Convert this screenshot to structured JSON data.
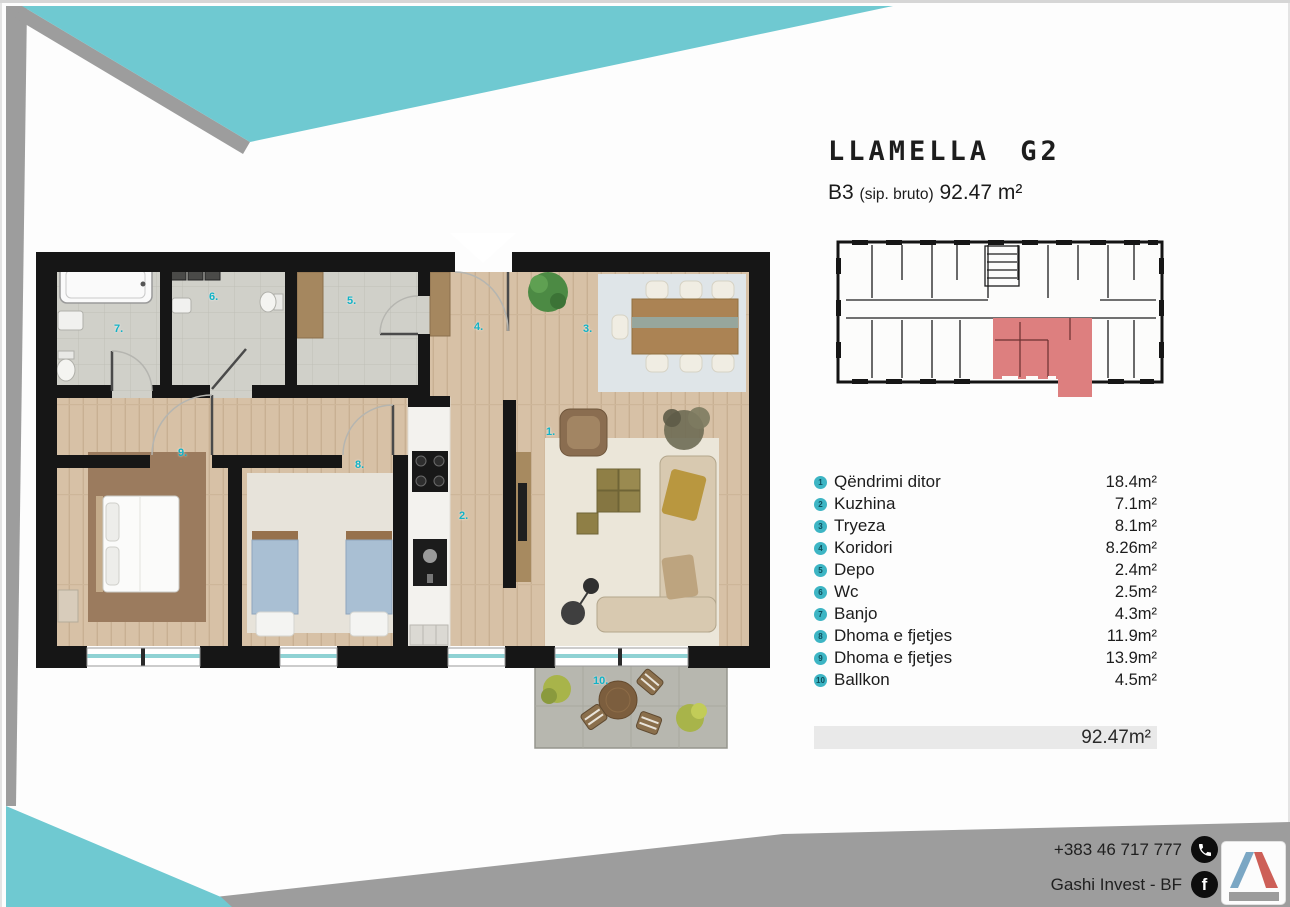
{
  "header": {
    "title": "LLAMELLA G2",
    "unit_code": "B3",
    "unit_note": "(sip. bruto)",
    "area": "92.47 m²"
  },
  "room_list": {
    "items": [
      {
        "n": "1",
        "name": "Qëndrimi ditor",
        "area": "18.4m²"
      },
      {
        "n": "2",
        "name": "Kuzhina",
        "area": "7.1m²"
      },
      {
        "n": "3",
        "name": "Tryeza",
        "area": "8.1m²"
      },
      {
        "n": "4",
        "name": "Koridori",
        "area": "8.26m²"
      },
      {
        "n": "5",
        "name": "Depo",
        "area": "2.4m²"
      },
      {
        "n": "6",
        "name": "Wc",
        "area": "2.5m²"
      },
      {
        "n": "7",
        "name": "Banjo",
        "area": "4.3m²"
      },
      {
        "n": "8",
        "name": "Dhoma e fjetjes",
        "area": "11.9m²"
      },
      {
        "n": "9",
        "name": "Dhoma e fjetjes",
        "area": "13.9m²"
      },
      {
        "n": "10",
        "name": "Ballkon",
        "area": "4.5m²"
      }
    ],
    "total": "92.47m²"
  },
  "floor_plan": {
    "labels": [
      {
        "t": "1.",
        "x": 546,
        "y": 426
      },
      {
        "t": "2.",
        "x": 459,
        "y": 510
      },
      {
        "t": "3.",
        "x": 583,
        "y": 323
      },
      {
        "t": "4.",
        "x": 474,
        "y": 321
      },
      {
        "t": "5.",
        "x": 347,
        "y": 295
      },
      {
        "t": "6.",
        "x": 209,
        "y": 291
      },
      {
        "t": "7.",
        "x": 114,
        "y": 323
      },
      {
        "t": "8.",
        "x": 355,
        "y": 459
      },
      {
        "t": "9.",
        "x": 178,
        "y": 447
      },
      {
        "t": "10.",
        "x": 593,
        "y": 675
      }
    ]
  },
  "contact": {
    "phone": "+383 46 717 777",
    "company": "Gashi Invest - BF",
    "phone_icon": "phone-icon",
    "facebook_icon": "facebook-icon",
    "facebook_glyph": "f"
  },
  "colors": {
    "accent_teal": "#6fc9d1",
    "band_gray": "#9d9d9d",
    "unit_highlight_red": "#dd7f7f",
    "bullet_teal": "#3db5c4",
    "label_cyan": "#12b2c6",
    "window_glass": "#8fd2d4",
    "wall_black": "#161616",
    "wood_floor": "#d7c1a6",
    "stone_floor": "#d0d0c9",
    "total_bar_bg": "#e9e9e9",
    "logo_blue": "#7ba7c4",
    "logo_red": "#cd5f57"
  }
}
